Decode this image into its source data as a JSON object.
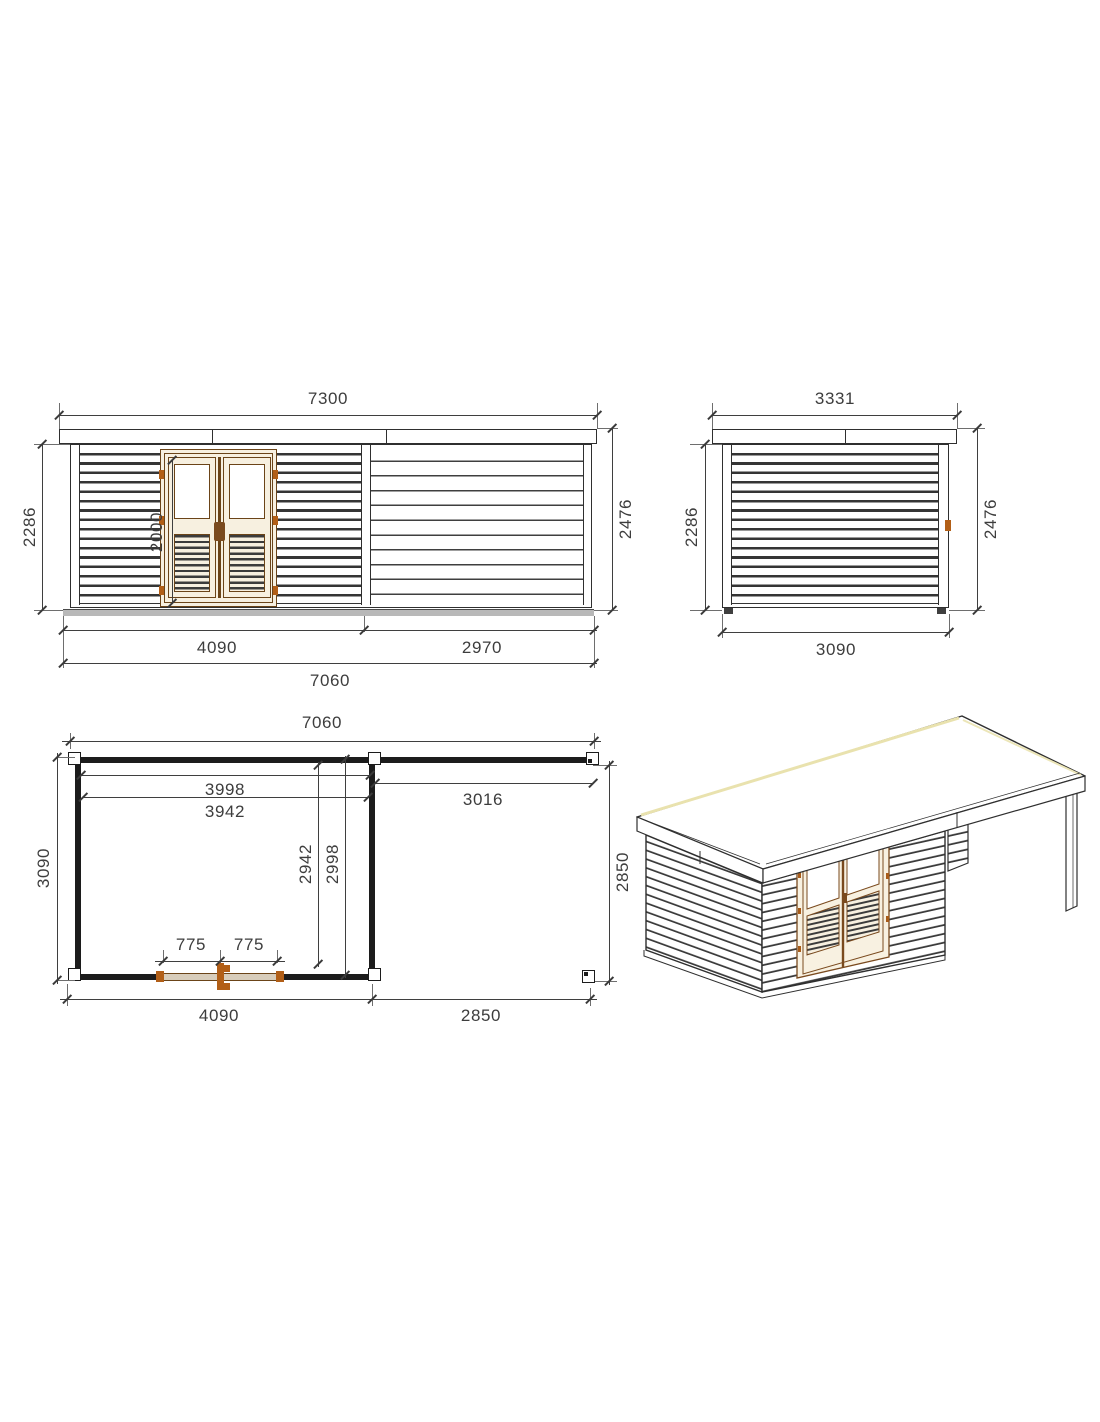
{
  "drawing": {
    "title": "Garden log cabin with side canopy - dimensioned drawing",
    "units": "mm",
    "colors": {
      "line": "#3f3f3f",
      "wall": "#1c1c1c",
      "door_frame": "#6b4418",
      "door_fill": "#f7f0e0",
      "hinge": "#b25f17",
      "floor": "#b8b8b8",
      "roof_highlight": "#e9e2ae"
    },
    "views": {
      "front": {
        "name": "front elevation",
        "dims": {
          "roof_width": "7300",
          "wall_height": "2286",
          "door_height": "2000",
          "total_height": "2476",
          "cabin_width": "4090",
          "canopy_width": "2970",
          "base_width": "7060"
        }
      },
      "side": {
        "name": "side elevation",
        "dims": {
          "roof_depth": "3331",
          "wall_height": "2286",
          "total_height": "2476",
          "base_depth": "3090"
        }
      },
      "plan": {
        "name": "floor plan",
        "dims": {
          "base_width": "7060",
          "cabin_inner_width": "3998",
          "cabin_wall_width": "3942",
          "canopy_clear_width": "3016",
          "base_depth": "3090",
          "cabin_inner_depth": "2942",
          "cabin_wall_depth": "2998",
          "canopy_depth": "2850",
          "door_leaf_left": "775",
          "door_leaf_right": "775",
          "cabin_base_width": "4090",
          "canopy_base_width": "2850"
        }
      },
      "iso": {
        "name": "isometric view"
      }
    }
  }
}
